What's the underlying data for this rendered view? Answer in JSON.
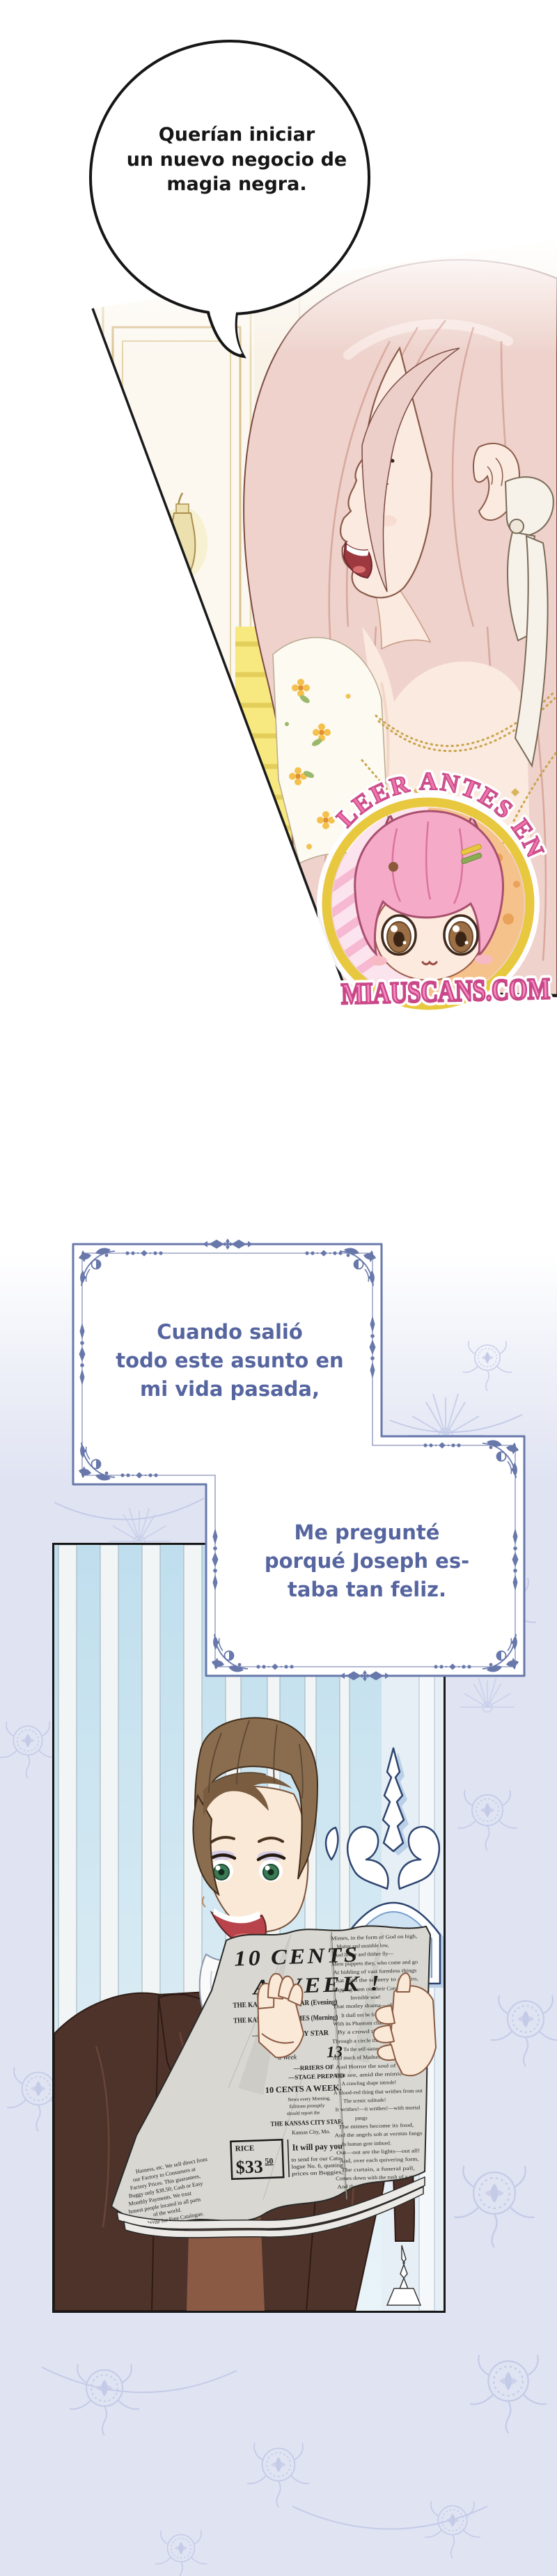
{
  "page": {
    "bg": "#ffffff",
    "wallpaper": "#dfe3f2",
    "wallpaper_motif": "#c4cbe7",
    "ornament_blue": "#6878ab",
    "note_text_blue": "#56659f",
    "watermark_pink": "#f07fb2",
    "watermark_gold": "#e8c83e"
  },
  "bubble1": {
    "lines": [
      "Querían iniciar",
      "un nuevo negocio de",
      "magia negra."
    ]
  },
  "box1": {
    "lines": [
      "Cuando salió",
      "todo este asunto en",
      "mi vida pasada,"
    ]
  },
  "box2": {
    "lines": [
      "Me pregunté",
      "porqué Joseph es-",
      "taba tan feliz."
    ]
  },
  "watermark": {
    "arc_text": "LEER ANTES EN",
    "site": "MIAUSCANS.COM"
  },
  "newspaper": {
    "headline": [
      "10 CENTS",
      "A WEEK !"
    ],
    "masthead": [
      "THE KANSAS CITY STAR (Evening)",
      "THE KANSAS CITY TIMES (Morning)",
      "— CITY SUNDAY STAR",
      "papers",
      "13",
      "a Week",
      "—RRIERS OF",
      "—STAGE PREPAID",
      "10 CENTS A WEEK.",
      "News every Morning,",
      "Editions promptly",
      "should report the",
      "THE KANSAS CITY STAR.",
      "Kansas City, Mo."
    ],
    "price_label": "RICE",
    "price_big": "$33",
    "price_sup": "50",
    "pay_you": "It will pay you",
    "ad": [
      "to send for our Cata-",
      "logue No. 6, quoting",
      "prices on Buggies,",
      "Harness, etc. We sell direct from",
      "our Factory to Consumers at",
      "Factory Prices. This guarantees,",
      "Buggy only $38.50; Cash or Easy",
      "Monthly Payments. We trust",
      "honest people located in all parts",
      "of the world.",
      "Write for Free Catalogue.",
      "MENTION THIS PAPER.",
      "DEP'T 860",
      "Est. 21 Leslie, Ill."
    ],
    "poem": [
      "Mimes, in the form of God on high,",
      "Mutter and mumble low,",
      "And hither and thither fly—",
      "Mere puppets they, who come and go",
      "At bidding of vast formless things",
      "That shift the scenery to and fro,",
      "Flapping from out their Condor wings",
      "Invisible woe!",
      "That motley drama—oh, be sure",
      "It shall not be forgot!",
      "With its Phantom chased for evermore",
      "By a crowd that seize it not,",
      "Through a circle that ever returneth in",
      "To the self-same spot,",
      "And much of Madness, and more of Sin,",
      "And Horror the soul of the plot.",
      "But see, amid the mimic rout,",
      "A crawling shape intrude!",
      "A blood-red thing that writhes from out",
      "The scenic solitude!",
      "It writhes!—it writhes!—with mortal",
      "pangs",
      "The mimes become its food,",
      "And the angels sob at vermin fangs",
      "In human gore imbued.",
      "Out—out are the lights—out all!",
      "And, over each quivering form,",
      "The curtain, a funeral pall,",
      "Comes down with the rush of a storm,",
      "And the angels, all pallid and wan,",
      "Uprising, unveiling, affirm"
    ]
  }
}
